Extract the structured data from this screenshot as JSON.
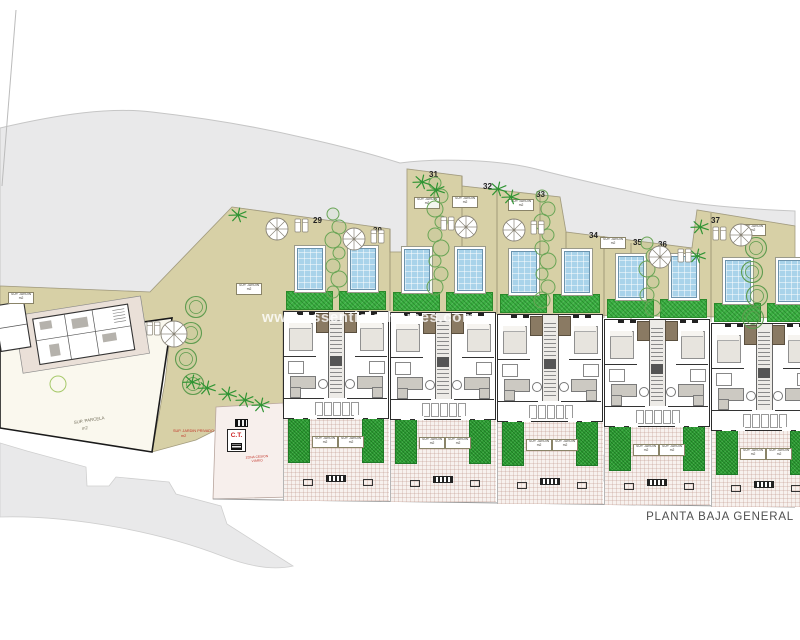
{
  "title": "PLANTA BAJA GENERAL",
  "watermark": "www.essentials-homes.com",
  "labels": {
    "garden_box_line1": "SUP. JARDIN",
    "garden_box_line2": "m2",
    "parcel_line1": "SUP. PARCELA",
    "parcel_line2": "m2",
    "villa_note_line1": "SUP. JARDIN PRIVADO",
    "villa_note_line2": "m2",
    "ct": "C.T.",
    "zone_note_line1": "ZONA CESION",
    "zone_note_line2": "VIARIO"
  },
  "colors": {
    "terrain": "#e9e9ea",
    "garden": "#d7d0a6",
    "pool": "#a9d3ea",
    "lawn": "#3cb043",
    "planting": "#2e9e35",
    "paving": "#f7f1ee",
    "wall": "#2b2b2b",
    "red": "#c23328"
  },
  "site": {
    "plot_numbers": [
      {
        "label": "29",
        "x": 313,
        "y": 216
      },
      {
        "label": "30",
        "x": 373,
        "y": 226
      },
      {
        "label": "31",
        "x": 429,
        "y": 170
      },
      {
        "label": "32",
        "x": 483,
        "y": 182
      },
      {
        "label": "33",
        "x": 536,
        "y": 190
      },
      {
        "label": "34",
        "x": 589,
        "y": 231
      },
      {
        "label": "35",
        "x": 633,
        "y": 238
      },
      {
        "label": "36",
        "x": 658,
        "y": 240
      },
      {
        "label": "37",
        "x": 711,
        "y": 216
      }
    ],
    "blocks": [
      {
        "x": 283,
        "y": 311
      },
      {
        "x": 390,
        "y": 312
      },
      {
        "x": 497,
        "y": 314
      },
      {
        "x": 604,
        "y": 319
      },
      {
        "x": 711,
        "y": 323
      }
    ],
    "garden_labels": [
      {
        "x": 8,
        "y": 292
      },
      {
        "x": 236,
        "y": 283
      },
      {
        "x": 414,
        "y": 197
      },
      {
        "x": 452,
        "y": 196
      },
      {
        "x": 508,
        "y": 199
      },
      {
        "x": 600,
        "y": 237
      },
      {
        "x": 740,
        "y": 224
      }
    ],
    "hedges": [
      {
        "x": 336,
        "y1": 214,
        "y2": 300
      },
      {
        "x": 438,
        "y1": 183,
        "y2": 300
      },
      {
        "x": 545,
        "y1": 196,
        "y2": 305
      },
      {
        "x": 650,
        "y1": 243,
        "y2": 318
      }
    ],
    "trees": [
      {
        "x": 196,
        "y": 307
      },
      {
        "x": 191,
        "y": 333
      },
      {
        "x": 186,
        "y": 359
      },
      {
        "x": 193,
        "y": 384
      },
      {
        "x": 756,
        "y": 248
      },
      {
        "x": 752,
        "y": 272
      },
      {
        "x": 757,
        "y": 296
      },
      {
        "x": 753,
        "y": 318
      }
    ],
    "palms": [
      {
        "x": 238,
        "y": 215
      },
      {
        "x": 422,
        "y": 182
      },
      {
        "x": 436,
        "y": 190
      },
      {
        "x": 498,
        "y": 189
      },
      {
        "x": 511,
        "y": 197
      },
      {
        "x": 700,
        "y": 227
      },
      {
        "x": 697,
        "y": 256
      },
      {
        "x": 192,
        "y": 382
      },
      {
        "x": 207,
        "y": 388
      },
      {
        "x": 228,
        "y": 394
      },
      {
        "x": 245,
        "y": 400
      },
      {
        "x": 261,
        "y": 405
      }
    ],
    "parasols": [
      {
        "x": 174,
        "y": 334,
        "r": 13
      },
      {
        "x": 277,
        "y": 229,
        "r": 11
      },
      {
        "x": 354,
        "y": 239,
        "r": 11
      },
      {
        "x": 466,
        "y": 227,
        "r": 11
      },
      {
        "x": 514,
        "y": 230,
        "r": 11
      },
      {
        "x": 660,
        "y": 257,
        "r": 11
      },
      {
        "x": 741,
        "y": 235,
        "r": 11
      }
    ],
    "loungers": [
      {
        "x": 147,
        "y": 322
      },
      {
        "x": 295,
        "y": 219
      },
      {
        "x": 371,
        "y": 230
      },
      {
        "x": 441,
        "y": 217
      },
      {
        "x": 531,
        "y": 221
      },
      {
        "x": 678,
        "y": 249
      },
      {
        "x": 713,
        "y": 227
      }
    ]
  }
}
